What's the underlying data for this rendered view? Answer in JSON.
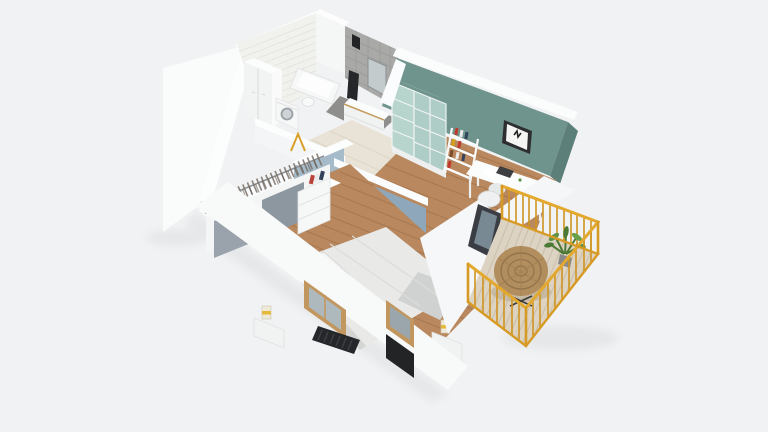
{
  "scene": {
    "title": "3d-apartment-floorplan-cutaway-render",
    "view": "isometric-top-down-dollhouse",
    "rooms": [
      {
        "name": "bathroom",
        "finishes": [
          "white-brick-tile-wall",
          "gray-stone-tile-wall"
        ],
        "objects": [
          "tall-storage-cabinet",
          "washing-machine",
          "bathtub",
          "toilet",
          "vanity-unit",
          "mirror",
          "dark-towel",
          "shower-fixture"
        ]
      },
      {
        "name": "hallway",
        "objects": [
          "yellow-coat-hooks",
          "white-interior-door",
          "light-floor"
        ]
      },
      {
        "name": "home-office",
        "wall_color": "#6f948e",
        "objects": [
          "frosted-glass-wardrobe",
          "ladder-bookshelf",
          "white-desk",
          "desk-chair",
          "framed-butterfly-art",
          "dark-round-armchair",
          "low-bookshelf",
          "balcony-glass-door",
          "wood-floor"
        ]
      },
      {
        "name": "bedroom",
        "wall_color": "#8fa7ba",
        "objects": [
          "double-bed-white-bedding",
          "two-pillows",
          "open-wardrobe-with-hangers",
          "dresser-with-books",
          "nightstand-with-lamp",
          "second-nightstand-with-lamp",
          "wood-framed-window",
          "second-wood-framed-window",
          "dark-slatted-radiator-bench",
          "wood-floor"
        ]
      },
      {
        "name": "balcony",
        "objects": [
          "yellow-metal-railing",
          "round-rattan-chair",
          "potted-green-plant",
          "light-wood-deck"
        ]
      }
    ],
    "palette": {
      "bg": "#f1f2f3",
      "wallWhite": "#f8f9fa",
      "wallCut": "#fcfdfd",
      "brick": "#f1f1ee",
      "grayTile": "#a9a9a7",
      "teal": "#6f948e",
      "tealDark": "#5d7f7a",
      "tealGlass": "#b7d4cd",
      "blueWall": "#8fa7ba",
      "blueWallLight": "#a6bbca",
      "woodFloor": "#b9885e",
      "woodLine": "#a0714a",
      "hallFloor": "#e9e3d7",
      "deck": "#ddd3c2",
      "deckLine": "#c8bca7",
      "railing": "#d79a24",
      "railingBright": "#e3a82e",
      "rattan": "#b28e5f",
      "rattanDark": "#93744a",
      "plant": "#4c7a36",
      "plantLight": "#69a14b",
      "windowWood": "#c2975f",
      "dark": "#2a2b2e",
      "bedWhite": "#e9e9e7",
      "furnitureWhite": "#f4f5f5",
      "lampYellow": "#e4b93c"
    }
  }
}
